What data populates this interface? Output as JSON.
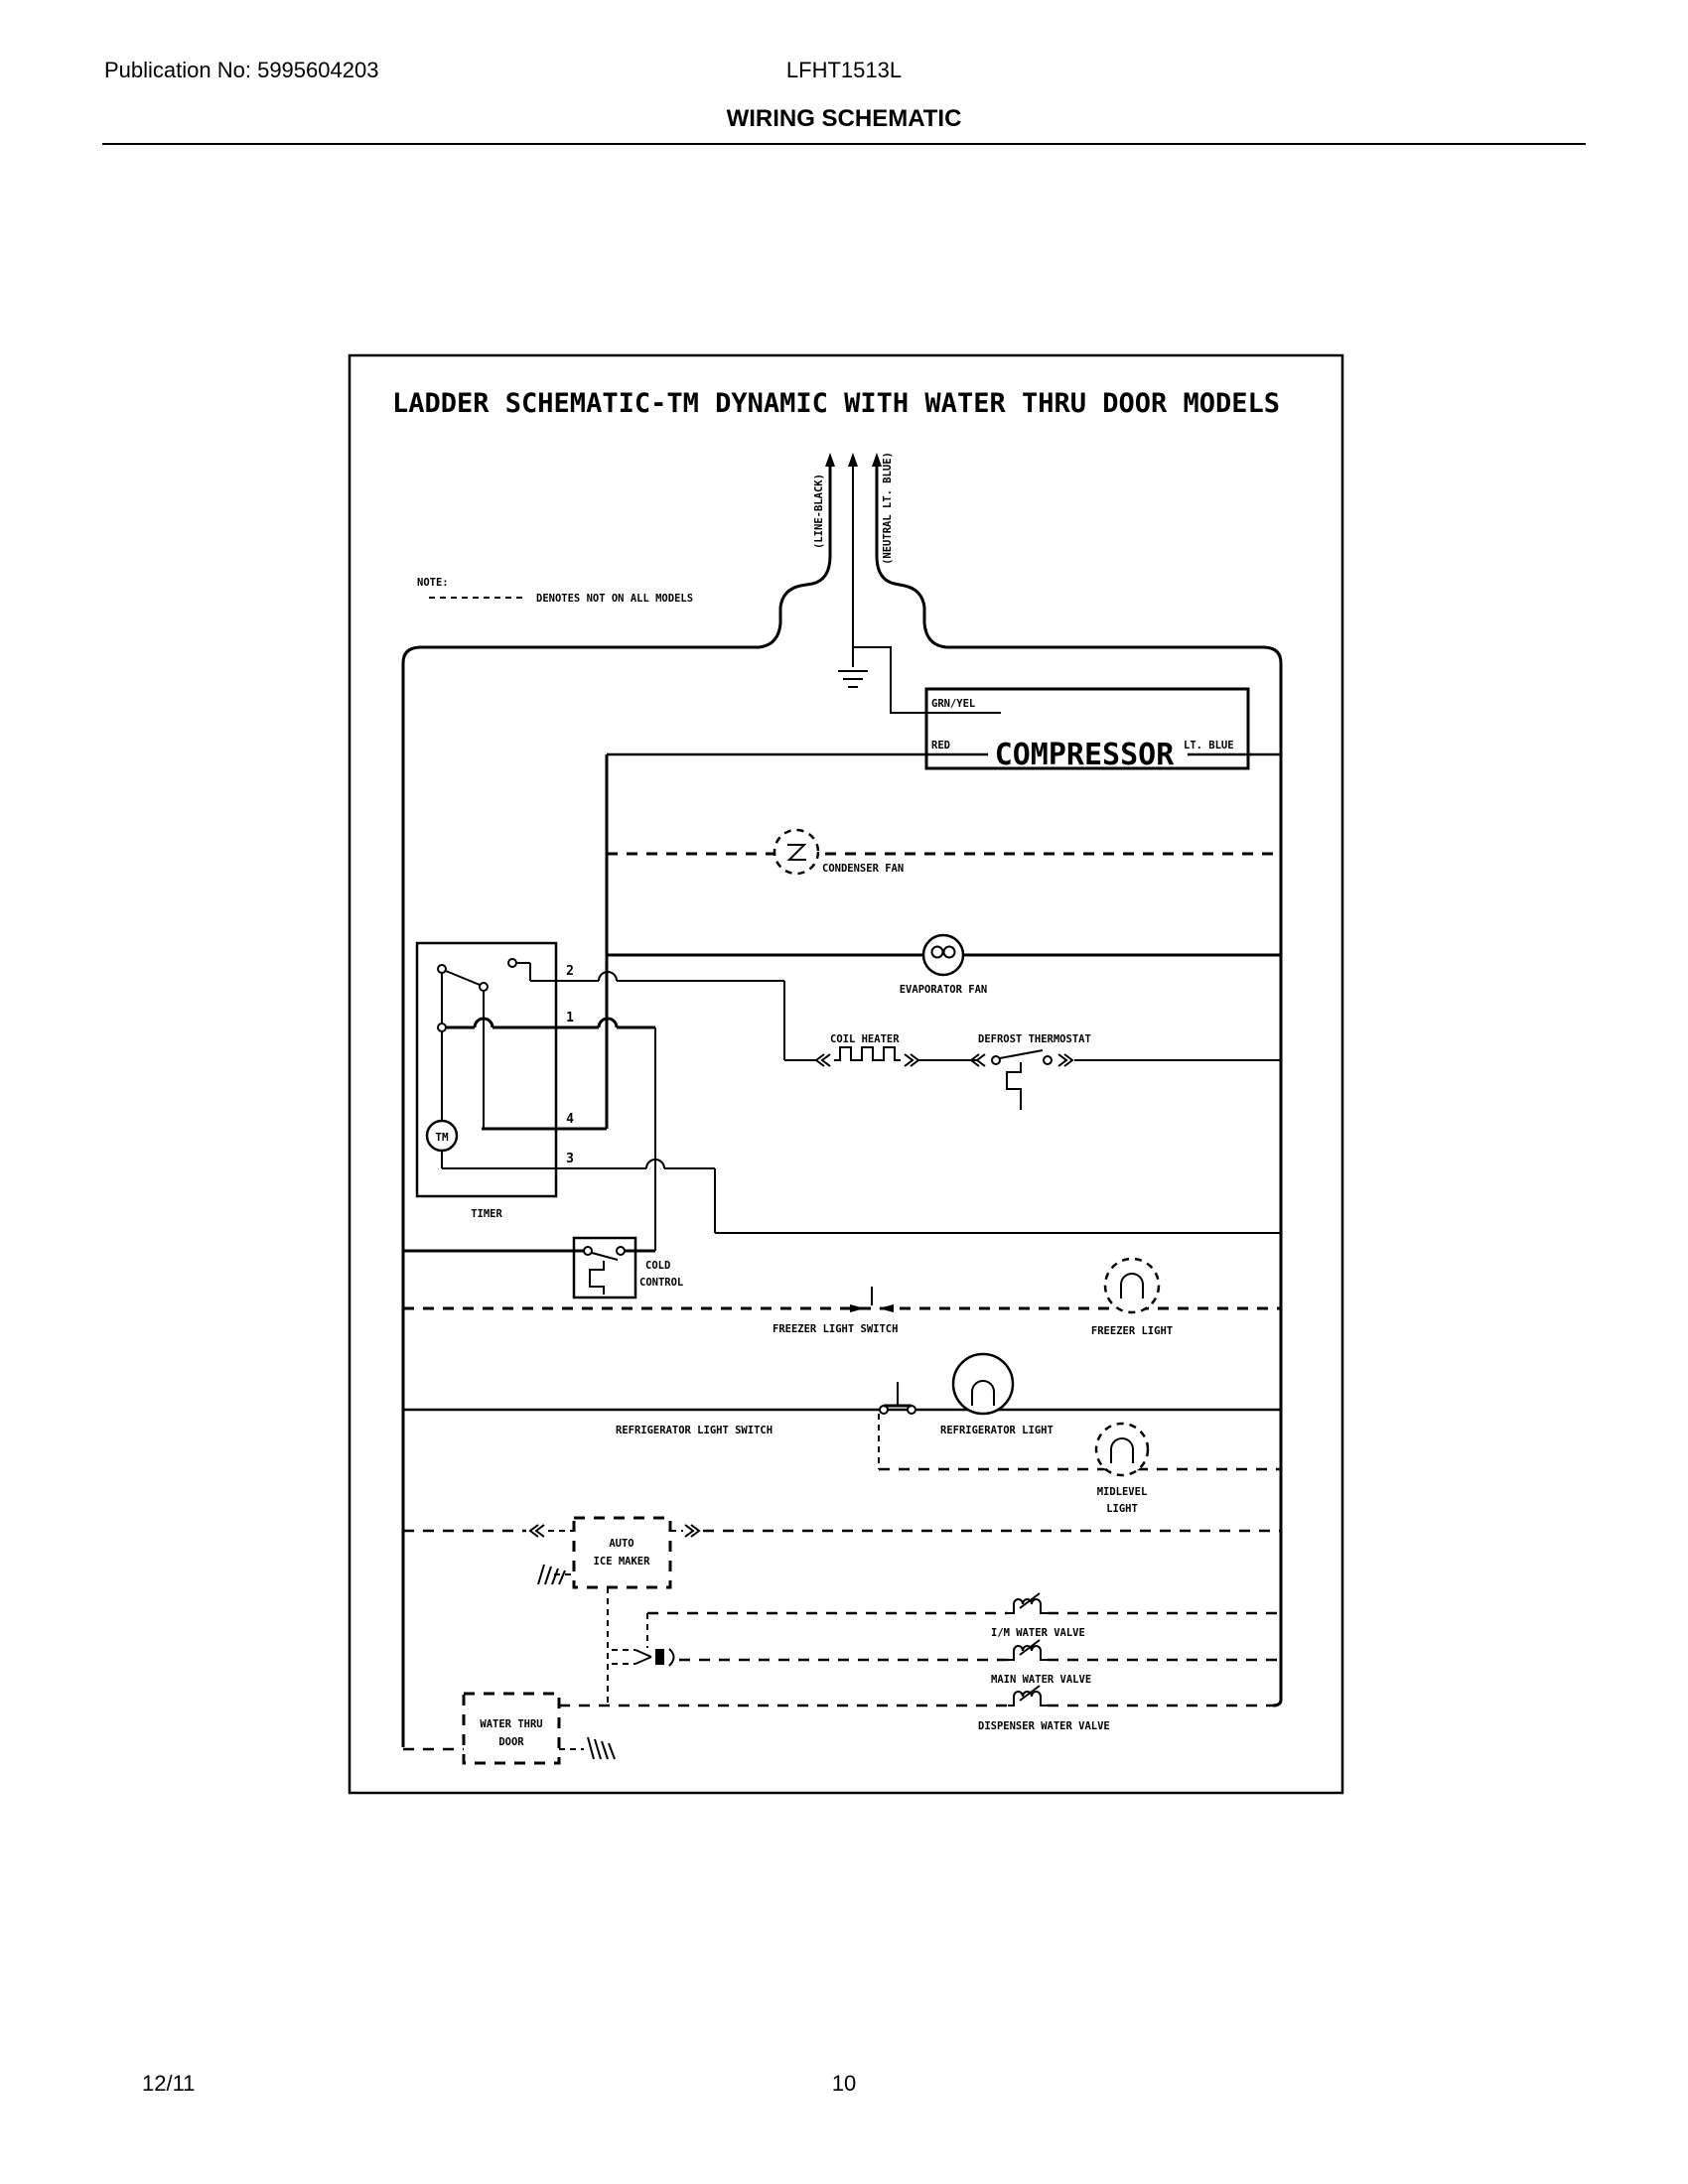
{
  "header": {
    "publication": "Publication No: 5995604203",
    "model": "LFHT1513L",
    "title": "WIRING SCHEMATIC"
  },
  "footer": {
    "date": "12/11",
    "page": "10"
  },
  "schematic": {
    "title": "LADDER SCHEMATIC-TM DYNAMIC WITH WATER THRU DOOR MODELS",
    "note_label": "NOTE:",
    "note_text": "DENOTES NOT ON ALL MODELS",
    "power": {
      "line": "(LINE-BLACK)",
      "neutral": "(NEUTRAL LT. BLUE)"
    },
    "compressor": {
      "label": "COMPRESSOR",
      "wire_grn_yel": "GRN/YEL",
      "wire_red": "RED",
      "wire_lt_blue": "LT. BLUE"
    },
    "components": {
      "condenser_fan": "CONDENSER FAN",
      "evaporator_fan": "EVAPORATOR FAN",
      "coil_heater": "COIL HEATER",
      "defrost_thermostat": "DEFROST THERMOSTAT",
      "timer": "TIMER",
      "timer_motor": "TM",
      "terminal_2": "2",
      "terminal_1": "1",
      "terminal_4": "4",
      "terminal_3": "3",
      "cold_control_1": "COLD",
      "cold_control_2": "CONTROL",
      "freezer_light_switch": "FREEZER LIGHT SWITCH",
      "freezer_light": "FREEZER LIGHT",
      "refrigerator_light_switch": "REFRIGERATOR LIGHT SWITCH",
      "refrigerator_light": "REFRIGERATOR LIGHT",
      "midlevel_light_1": "MIDLEVEL",
      "midlevel_light_2": "LIGHT",
      "auto_ice_maker_1": "AUTO",
      "auto_ice_maker_2": "ICE MAKER",
      "im_water_valve": "I/M WATER VALVE",
      "main_water_valve": "MAIN WATER VALVE",
      "dispenser_water_valve": "DISPENSER WATER VALVE",
      "water_thru_door_1": "WATER THRU",
      "water_thru_door_2": "DOOR"
    },
    "colors": {
      "ink": "#000000",
      "paper": "#ffffff"
    }
  }
}
